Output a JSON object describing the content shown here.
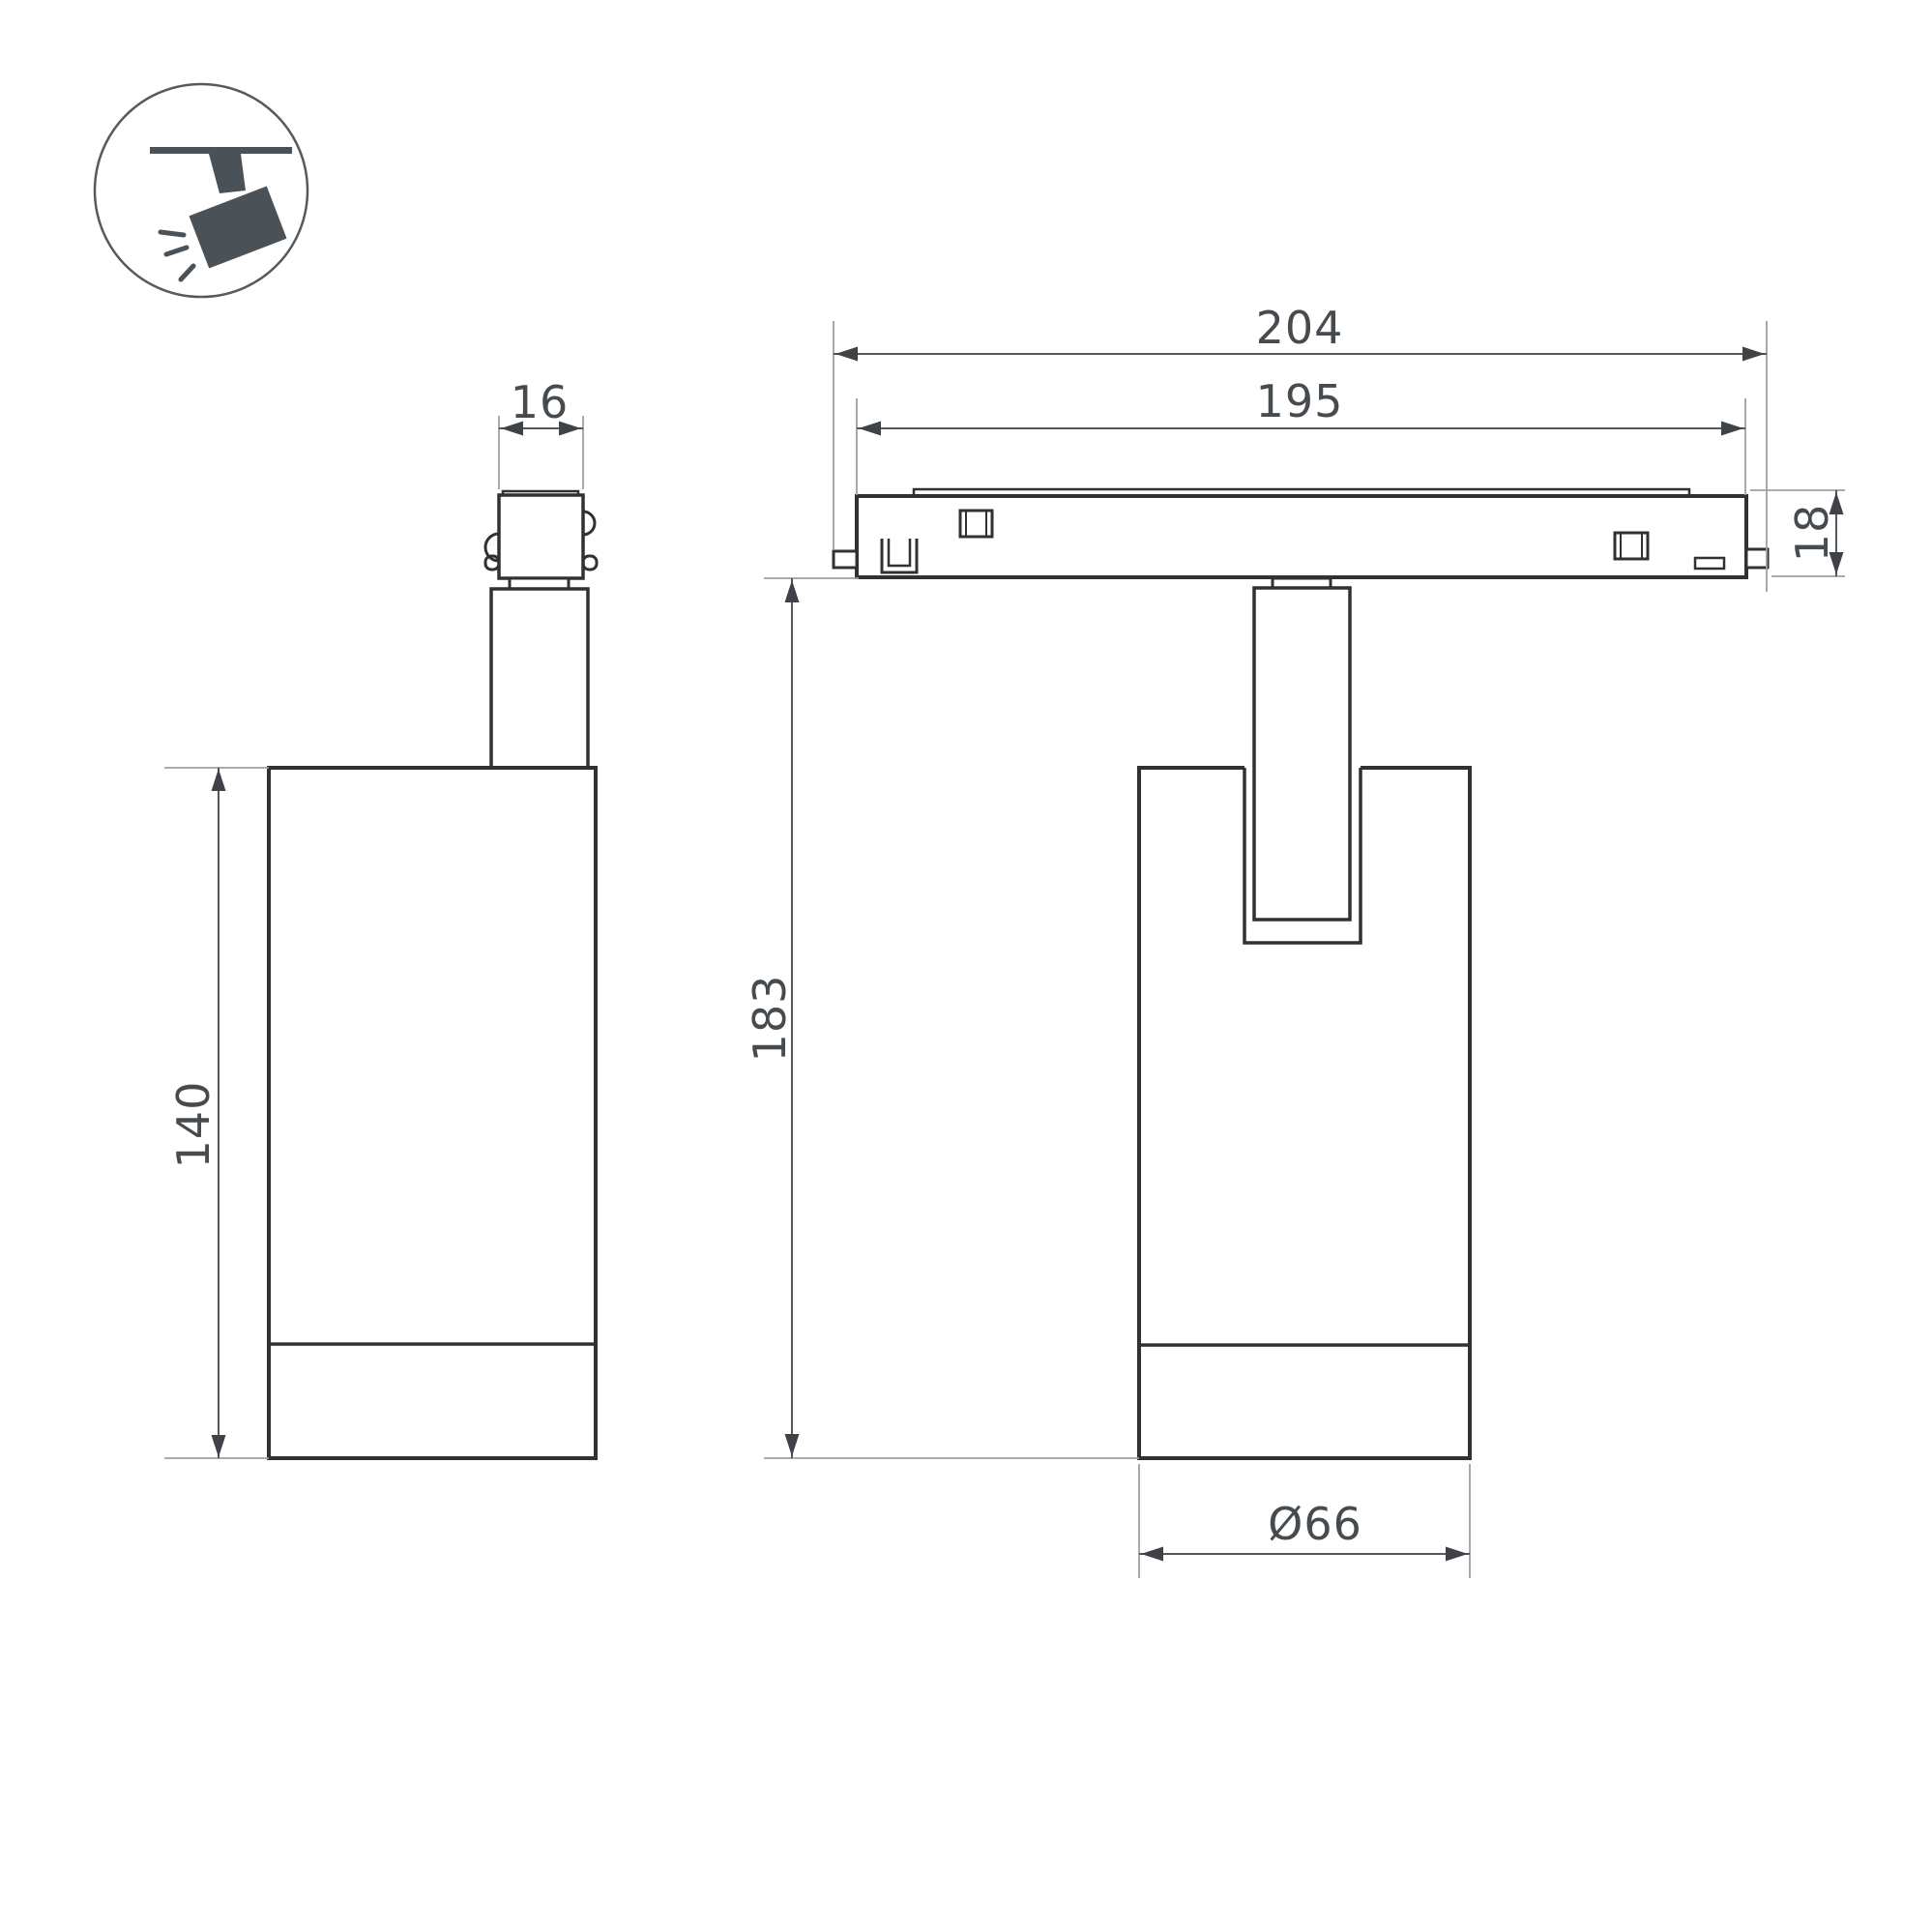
{
  "drawing": {
    "type": "technical-dimension-drawing",
    "subject": "magnetic track spotlight luminaire, two orthographic views",
    "icon": {
      "label": "track-spotlight-pictogram"
    },
    "dims": {
      "adapter_width": "16",
      "track_overall_length": "204",
      "track_body_length": "195",
      "track_height": "18",
      "body_height": "140",
      "overall_height": "183",
      "body_diameter": "Ø66"
    },
    "colors": {
      "background": "#ffffff",
      "outline": "#2e3235",
      "dimension_line": "#54585c",
      "extension_line": "#9aa0a5",
      "dimension_text": "#464b4f",
      "icon": "#4a5157"
    }
  }
}
